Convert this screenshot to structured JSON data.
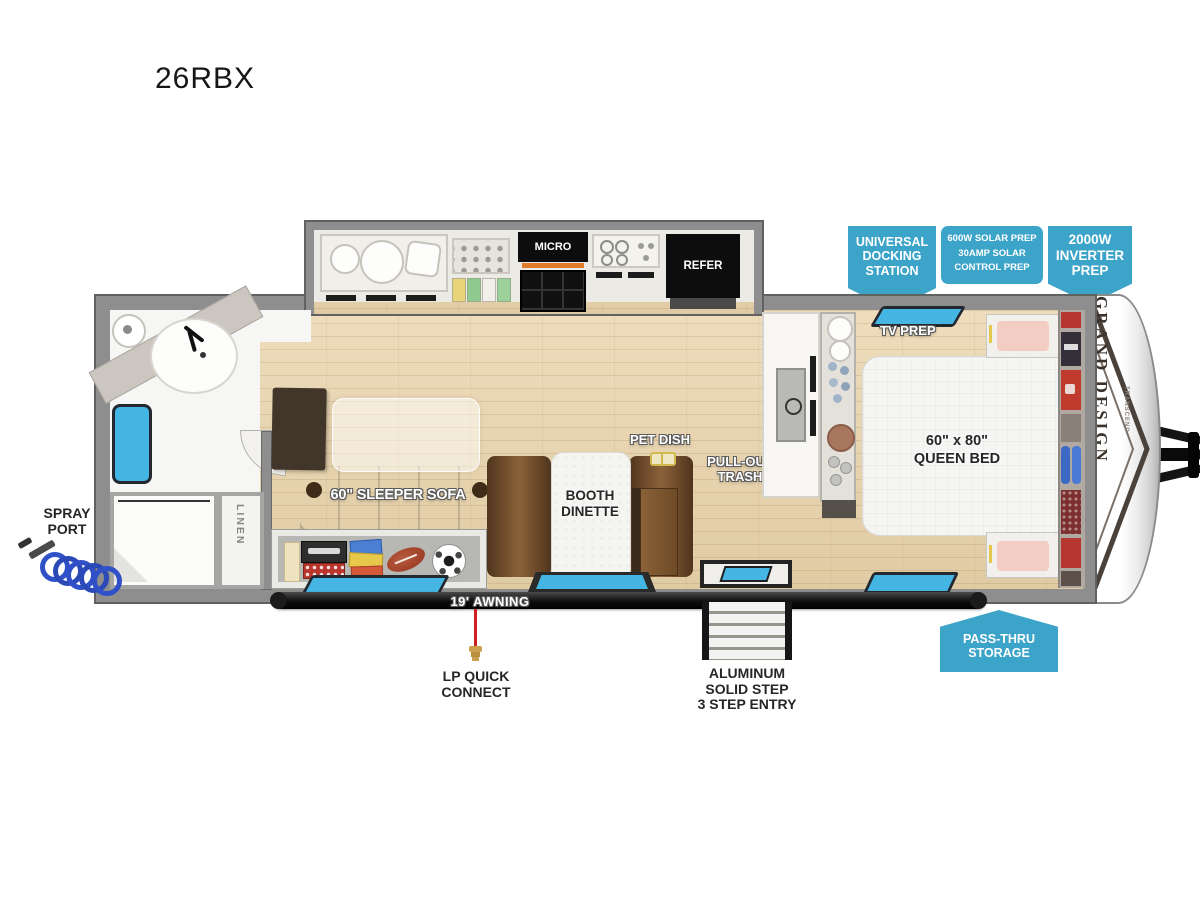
{
  "title": "26RBX",
  "callouts": {
    "docking": "UNIVERSAL\nDOCKING\nSTATION",
    "solar": "600W SOLAR PREP\n30AMP SOLAR\nCONTROL PREP",
    "inverter": "2000W\nINVERTER\nPREP",
    "pass_thru": "PASS-THRU\nSTORAGE"
  },
  "labels": {
    "micro": "MICRO",
    "refer": "REFER",
    "tv_prep": "TV PREP",
    "queen_bed": "60\" x 80\"\nQUEEN BED",
    "sleeper_sofa": "60\" SLEEPER SOFA",
    "booth_dinette": "BOOTH\nDINETTE",
    "pet_dish": "PET DISH",
    "pull_out_trash": "PULL-OUT\nTRASH",
    "linen": "LINEN",
    "awning": "19' AWNING",
    "spray_port": "SPRAY\nPORT",
    "lp_quick_connect": "LP QUICK\nCONNECT",
    "entry_step": "ALUMINUM\nSOLID STEP\n3 STEP ENTRY",
    "brand": "GRAND DESIGN",
    "brand_series": "TRANSCEND"
  },
  "colors": {
    "callout_blue": "#3DA4C9",
    "window_blue": "#45B5E3",
    "wall_gray": "#8E8E8E",
    "floor_wood": "#E6D2AD",
    "furniture_brown": "#6B4C2E",
    "awning_black": "#1A1A1A",
    "lp_red": "#CF1F1F",
    "hose_blue": "#3050C8"
  }
}
